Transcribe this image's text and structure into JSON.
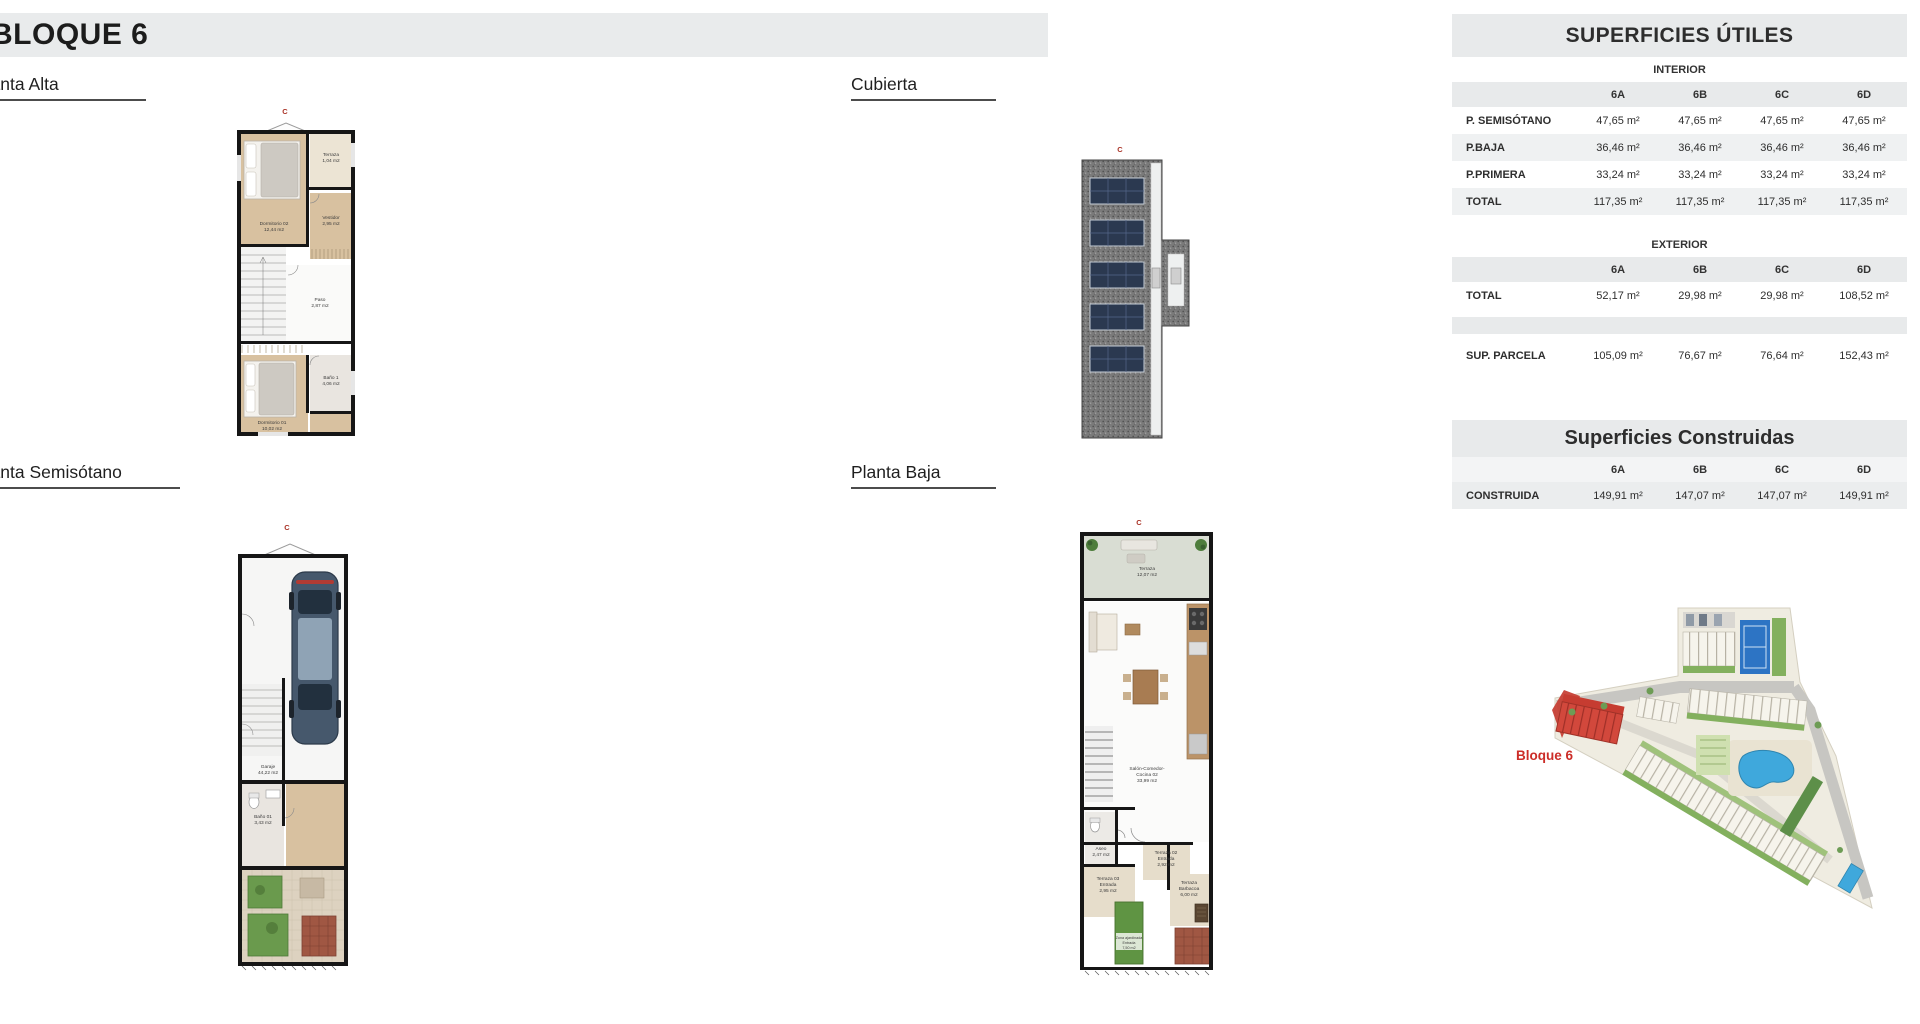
{
  "header": {
    "title": "BLOQUE 6"
  },
  "sections": {
    "planta_alta": "Planta Alta",
    "cubierta": "Cubierta",
    "planta_semisotano": "Planta Semisótano",
    "planta_baja": "Planta Baja"
  },
  "tables": {
    "utiles": {
      "title": "SUPERFICIES ÚTILES",
      "interior_label": "INTERIOR",
      "exterior_label": "EXTERIOR",
      "columns": [
        "6A",
        "6B",
        "6C",
        "6D"
      ],
      "interior_rows": [
        {
          "label": "P. SEMISÓTANO",
          "values": [
            "47,65 m²",
            "47,65 m²",
            "47,65 m²",
            "47,65 m²"
          ]
        },
        {
          "label": "P.BAJA",
          "values": [
            "36,46 m²",
            "36,46 m²",
            "36,46 m²",
            "36,46 m²"
          ]
        },
        {
          "label": "P.PRIMERA",
          "values": [
            "33,24 m²",
            "33,24 m²",
            "33,24 m²",
            "33,24 m²"
          ]
        },
        {
          "label": "TOTAL",
          "values": [
            "117,35 m²",
            "117,35 m²",
            "117,35 m²",
            "117,35 m²"
          ]
        }
      ],
      "exterior_rows": [
        {
          "label": "TOTAL",
          "values": [
            "52,17 m²",
            "29,98 m²",
            "29,98 m²",
            "108,52 m²"
          ]
        },
        {
          "label": "SUP. PARCELA",
          "values": [
            "105,09 m²",
            "76,67 m²",
            "76,64 m²",
            "152,43 m²"
          ]
        }
      ]
    },
    "construidas": {
      "title": "Superficies Construidas",
      "columns": [
        "6A",
        "6B",
        "6C",
        "6D"
      ],
      "rows": [
        {
          "label": "CONSTRUIDA",
          "values": [
            "149,91 m²",
            "147,07 m²",
            "147,07 m²",
            "149,91 m²"
          ]
        }
      ]
    }
  },
  "plans": {
    "marker": "C",
    "alta": {
      "rooms": {
        "terraza": {
          "name": "Terraza",
          "area": "1,04 m2"
        },
        "dormitorio02": {
          "name": "Dormitorio 02",
          "area": "12,44 m2"
        },
        "vestidor": {
          "name": "Vestidor",
          "area": "2,95 m2"
        },
        "paso": {
          "name": "Paso",
          "area": "2,87 m2"
        },
        "bano1": {
          "name": "Baño 1",
          "area": "4,06 m2"
        },
        "dormitorio01": {
          "name": "Dormitorio 01",
          "area": "10,02 m2"
        }
      }
    },
    "semisotano": {
      "rooms": {
        "garaje": {
          "name": "Garaje",
          "area": "44,22 m2"
        },
        "bano01": {
          "name": "Baño 01",
          "area": "3,43 m2"
        }
      }
    },
    "baja": {
      "rooms": {
        "terraza_superior": {
          "name": "Terraza",
          "area": "12,07 m2"
        },
        "salon": {
          "line1": "Salón-Comedor-",
          "line2": "Cocina 02",
          "area": "33,99 m2"
        },
        "aseo": {
          "name": "Aseo",
          "area": "2,47 m2"
        },
        "terraza02": {
          "name": "Terraza 02",
          "sub": "Entrada",
          "area": "2,92 m2"
        },
        "terraza03": {
          "name": "Terraza 03",
          "sub": "Entrada",
          "area": "2,95 m2"
        },
        "barbacoa": {
          "line1": "Terraza",
          "line2": "Barbacoa",
          "area": "6,00 m2"
        },
        "zona_ajardinada": {
          "name": "Zona ajardinada",
          "sub": "Entrada",
          "area": "7,50 m2"
        }
      }
    }
  },
  "site": {
    "label": "Bloque 6"
  },
  "colors": {
    "accent_red": "#a93226",
    "band_gray": "#e8eaeb",
    "pool_blue": "#3fa8dc",
    "floor_wood": "#d8c1a0"
  }
}
